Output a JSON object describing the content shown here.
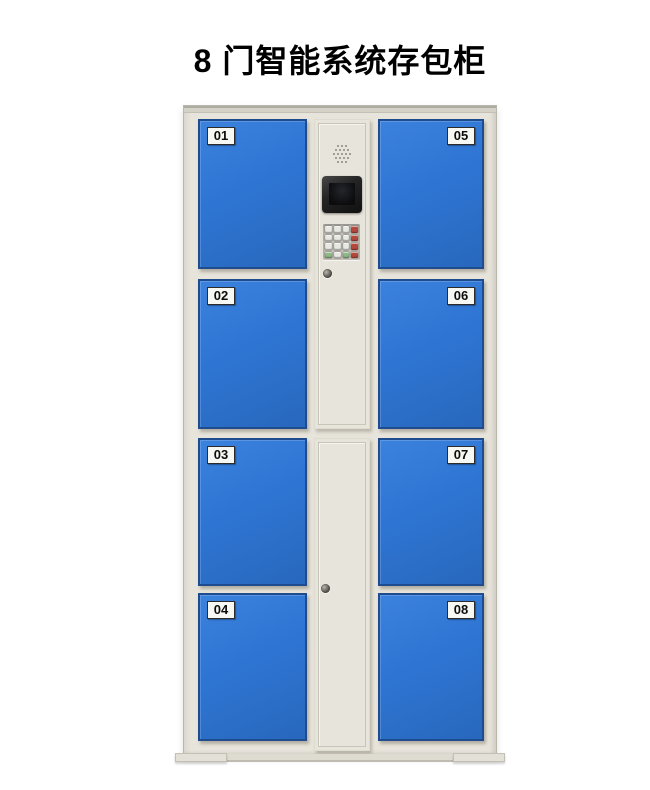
{
  "title": "8 门智能系统存包柜",
  "locker": {
    "doors": [
      {
        "label": "01"
      },
      {
        "label": "02"
      },
      {
        "label": "03"
      },
      {
        "label": "04"
      },
      {
        "label": "05"
      },
      {
        "label": "06"
      },
      {
        "label": "07"
      },
      {
        "label": "08"
      }
    ],
    "control_panel": {
      "speaker": "speaker-grille",
      "screen": "lcd-display",
      "keypad_layout": [
        [
          "grey",
          "grey",
          "grey",
          "red"
        ],
        [
          "grey",
          "grey",
          "grey",
          "red"
        ],
        [
          "grey",
          "grey",
          "grey",
          "red"
        ],
        [
          "green",
          "grey",
          "green",
          "red"
        ]
      ],
      "locks": [
        "cam-lock-upper",
        "cam-lock-lower"
      ]
    }
  },
  "colors": {
    "title_color": "#000000",
    "door_blue": "#2e75d3",
    "door_border": "#1e4c8f",
    "cabinet_beige": "#e7e4db",
    "cabinet_edge": "#d4d1c7",
    "label_bg": "#f7f7f4",
    "label_border": "#2b2b2b",
    "key_grey": "#e8e8e3",
    "key_red": "#b5483c",
    "key_green": "#8cb984",
    "screen_bezel": "#242424",
    "screen_display": "#0c0c0e"
  }
}
